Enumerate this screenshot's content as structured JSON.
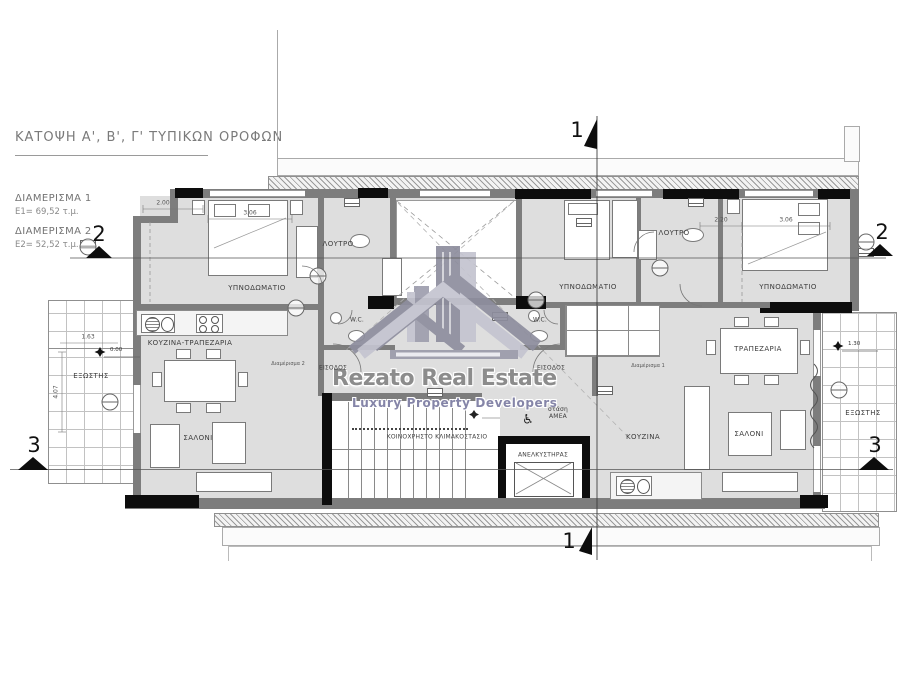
{
  "colors": {
    "wall": "#7d7d7d",
    "floor": "#dedede",
    "black": "#0d0d0d",
    "logo_dark": "#8e8e9e",
    "logo_light": "#c4c4d0",
    "watermark": "#8c8c8c",
    "watermark_sub": "#8585a8"
  },
  "title": {
    "text": "ΚΑΤΟΨΗ Α', Β', Γ' ΤΥΠΙΚΩΝ ΟΡΟΦΩΝ"
  },
  "apartments": [
    {
      "name": "ΔΙΑΜΕΡΙΣΜΑ 1",
      "area": "Ε1= 69,52 τ.μ."
    },
    {
      "name": "ΔΙΑΜΕΡΙΣΜΑ 2",
      "area": "Ε2= 52,52 τ.μ."
    }
  ],
  "watermark": {
    "line1": "Rezato Real Estate",
    "line2": "Luxury  Property  Developers"
  },
  "rooms": [
    {
      "label": "ΥΠΝΟΔΩΜΑΤΙΟ"
    },
    {
      "label": "ΛΟΥΤΡΟ"
    },
    {
      "label": "W.C."
    },
    {
      "label": "ΚΟΥΖΙΝΑ-ΤΡΑΠΕΖΑΡΙΑ"
    },
    {
      "label": "ΣΑΛΟΝΙ"
    },
    {
      "label": "ΕΞΩΣΤΗΣ"
    },
    {
      "label": "ΕΙΣΟΔΟΣ"
    },
    {
      "label": "ΥΠΝΟΔΩΜΑΤΙΟ"
    },
    {
      "label": "ΛΟΥΤΡΟ"
    },
    {
      "label": "W.C."
    },
    {
      "label": "ΥΠΝΟΔΩΜΑΤΙΟ"
    },
    {
      "label": "ΤΡΑΠΕΖΑΡΙΑ"
    },
    {
      "label": "ΚΟΥΖΙΝΑ"
    },
    {
      "label": "ΣΑΛΟΝΙ"
    },
    {
      "label": "ΕΞΩΣΤΗΣ"
    },
    {
      "label": "ΕΙΣΟΔΟΣ"
    },
    {
      "label": "ΚΟΙΝΟΧΡΗΣΤΟ ΚΛΙΜΑΚΟΣΤΑΣΙΟ"
    },
    {
      "label": "ΑΝΕΛΚΥΣΤΗΡΑΣ"
    },
    {
      "label": "στάση\nΑΜΕΑ"
    },
    {
      "label": "Διαμέρισμα 2"
    },
    {
      "label": "Διαμέρισμα 1"
    }
  ],
  "icons": {
    "wheelchair": "♿"
  },
  "section_markers": {
    "s1_top": "1",
    "s1_bottom": "1",
    "s2_left": "2",
    "s2_right": "2",
    "s3_left": "3",
    "s3_right": "3"
  },
  "levels": [
    {
      "value": "0.00"
    },
    {
      "value": "1.30"
    }
  ],
  "dimensions": [
    {
      "value": "2.00"
    },
    {
      "value": "3.06"
    },
    {
      "value": "2.20"
    },
    {
      "value": "3.06"
    },
    {
      "value": "4.07"
    },
    {
      "value": "1.63"
    }
  ]
}
